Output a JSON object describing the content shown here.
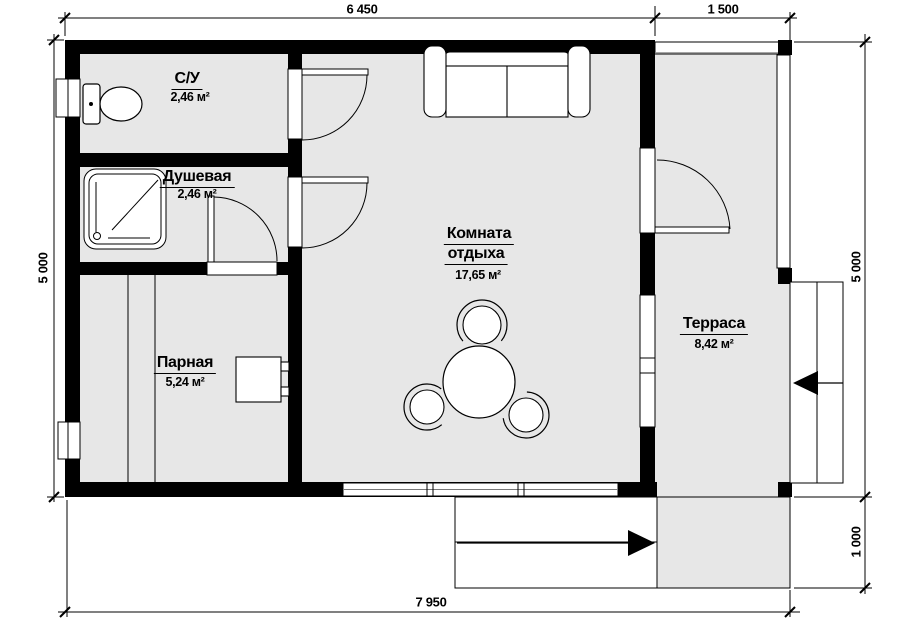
{
  "rooms": {
    "wc": {
      "name": "С/У",
      "area": "2,46 м²"
    },
    "shower": {
      "name": "Душевая",
      "area": "2,46 м²"
    },
    "steam": {
      "name": "Парная",
      "area": "5,24 м²"
    },
    "lounge": {
      "name_line1": "Комната",
      "name_line2": "отдыха",
      "area": "17,65 м²"
    },
    "terrace": {
      "name": "Терраса",
      "area": "8,42 м²"
    }
  },
  "dimensions": {
    "top_main": "6 450",
    "top_terrace": "1 500",
    "left": "5 000",
    "right_main": "5 000",
    "right_porch": "1 000",
    "bottom": "7 950"
  },
  "colors": {
    "floor": "#e7e7e7",
    "wall": "#000000",
    "line": "#000000"
  }
}
